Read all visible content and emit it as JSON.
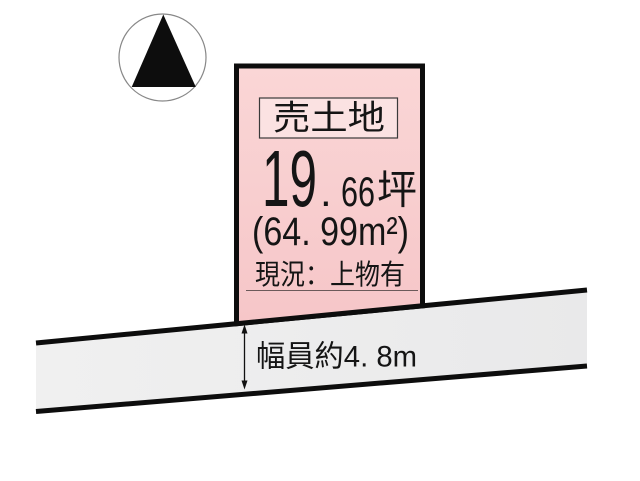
{
  "diagram": {
    "kind": "land-plot-diagram",
    "background_color": "#ffffff"
  },
  "compass": {
    "icon": "north-triangle-icon",
    "circle_color": "#888888",
    "triangle_color": "#0d0d0d"
  },
  "parcel": {
    "sale_label": "売土地",
    "area_tsubo": {
      "int": "19",
      "dot": ".",
      "frac": "66",
      "unit": "坪"
    },
    "area_sqm": "(64. 99m²)",
    "status": "現況：上物有",
    "fill_color": "#F8CCCC",
    "label_box_fill": "#FBE2E2",
    "border_color": "#0d0d0d"
  },
  "road": {
    "width_label": "幅員約4. 8m",
    "fill_color": "#ECECEC",
    "edge_color": "#0d0d0d",
    "arrow_color": "#111111"
  }
}
